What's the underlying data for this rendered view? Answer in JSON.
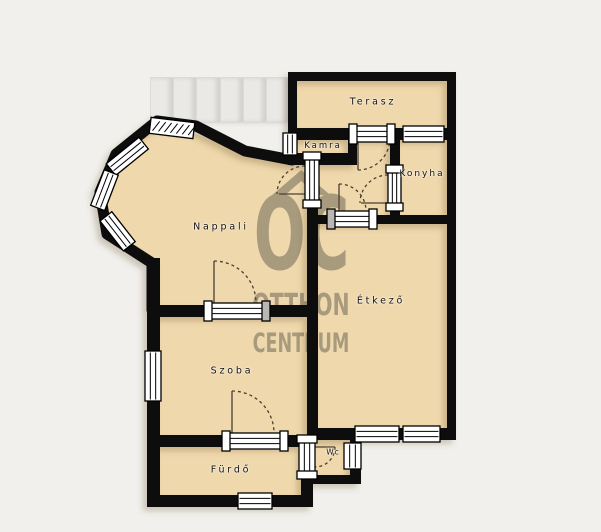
{
  "floorplan": {
    "type": "residential floor plan",
    "rooms": [
      {
        "label": "Terasz"
      },
      {
        "label": "Kamra"
      },
      {
        "label": "Konyha"
      },
      {
        "label": "Nappali"
      },
      {
        "label": "Étkező"
      },
      {
        "label": "Szoba"
      },
      {
        "label": "Fürdő"
      },
      {
        "label": "Wc"
      }
    ],
    "watermark": {
      "icon": "house-roof",
      "line1": "OC",
      "line2": "OTTHON",
      "line3": "CENTRUM"
    },
    "colors": {
      "background": "#f1f0ec",
      "floor": "#efd8ac",
      "wall": "#0a0a0a",
      "window": "#ffffff",
      "watermark": "#968b72",
      "stairs": "#eae9e6"
    }
  }
}
